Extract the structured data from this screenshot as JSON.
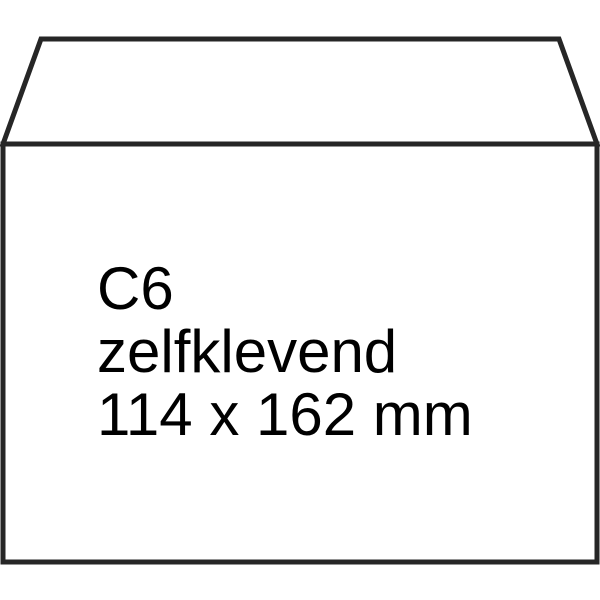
{
  "product_image": {
    "subject": "envelope",
    "label": {
      "line1": "C6",
      "line2": "zelfklevend",
      "line3": "114 x 162 mm"
    },
    "colors": {
      "outline": "#262626",
      "text": "#000000",
      "fill": "#ffffff"
    }
  }
}
